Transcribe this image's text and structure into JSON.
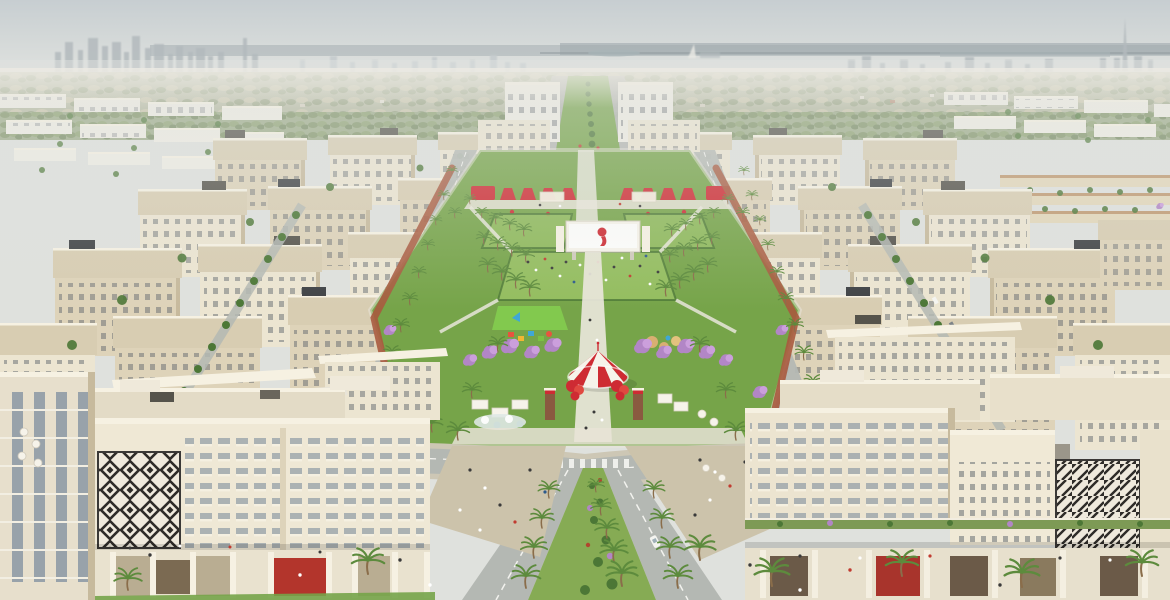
{
  "scene": {
    "type": "aerial-architectural-rendering",
    "landmarks": [
      "distant-city-skyline-left",
      "burj-khalifa-silhouette-right",
      "hazy-sea-horizon",
      "white-apartment-rows",
      "beige-midrise-blocks",
      "central-green-park",
      "palm-groves",
      "purple-flowering-trees",
      "red-awning-row",
      "event-screen-with-red-logo",
      "striped-carousel-tent",
      "red-sculpture-trees",
      "playground",
      "jogging-track",
      "y-shaped-road-junction",
      "palm-median",
      "geometric-pattern-facades",
      "retail-podium-arcades"
    ]
  },
  "colors": {
    "sky_top": "#c7ced1",
    "sky_bottom": "#e6e7e2",
    "skyline_gray": "#b3babd",
    "skyline_far": "#c4cbcd",
    "water_gray": "#73828a",
    "scrub_base": "#b4b89e",
    "scrub_dark": "#8f9c77",
    "scrub_light": "#c8c4a6",
    "bldg_white": "#efede4",
    "bldg_light": "#ece5d1",
    "bldg_mid": "#ded3b9",
    "bldg_shadow": "#c7ba9d",
    "cornice": "#f6f1e2",
    "roof_tan": "#d8cdb2",
    "roof_dark": "#55534b",
    "window_dark": "#6a6f74",
    "glass_blue": "#8a98a3",
    "park_green": "#76a449",
    "lawn_light": "#93bd5e",
    "lawn_bright": "#82c94e",
    "tree_green": "#4c7736",
    "palm_green": "#5d8b3d",
    "trunk_brown": "#8a6d4a",
    "purple_tree": "#b286c6",
    "purple_tree_light": "#cb9fdc",
    "accent_red": "#ce2b33",
    "red_dark": "#a8342c",
    "tent_white": "#f6f3ea",
    "track_terracotta": "#a95a3e",
    "road_gray": "#b4b8b3",
    "sidewalk": "#cdc7b5",
    "plaza_paving": "#ccc3ab",
    "lane_marking": "#f2f2ee",
    "median_green": "#86ab54",
    "pattern_ink": "#2e2b28",
    "pattern_bg": "#efe9dc",
    "water_feature": "#dfe8e4",
    "people_dark": "#3a3a3a",
    "people_white": "#ffffff",
    "people_red": "#c13b30",
    "people_blue": "#2d5a8c",
    "car_white": "#f4f4f0",
    "pillar_brown": "#8a5a40"
  }
}
